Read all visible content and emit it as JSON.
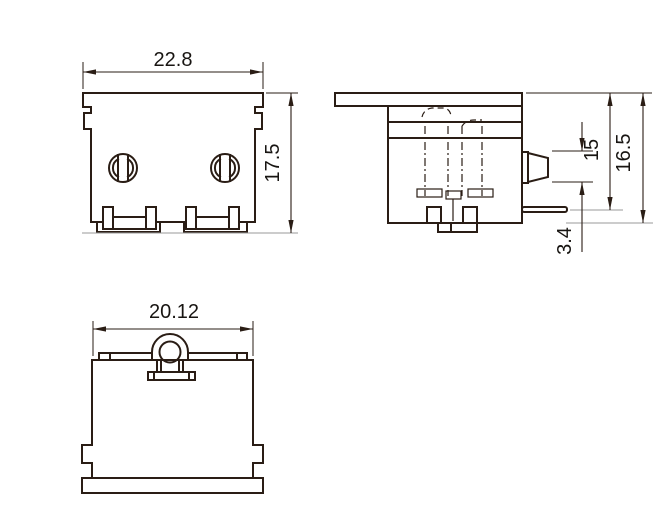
{
  "colors": {
    "line": "#2a1d15",
    "dim": "#2a1d15",
    "ext": "#9a9a9a",
    "text": "#181512",
    "bg": "#ffffff"
  },
  "dimensions": {
    "front_width": "22.8",
    "front_height": "17.5",
    "side_pin": "15",
    "side_total": "16.5",
    "side_tab": "3.4",
    "bottom_width": "20.12"
  }
}
